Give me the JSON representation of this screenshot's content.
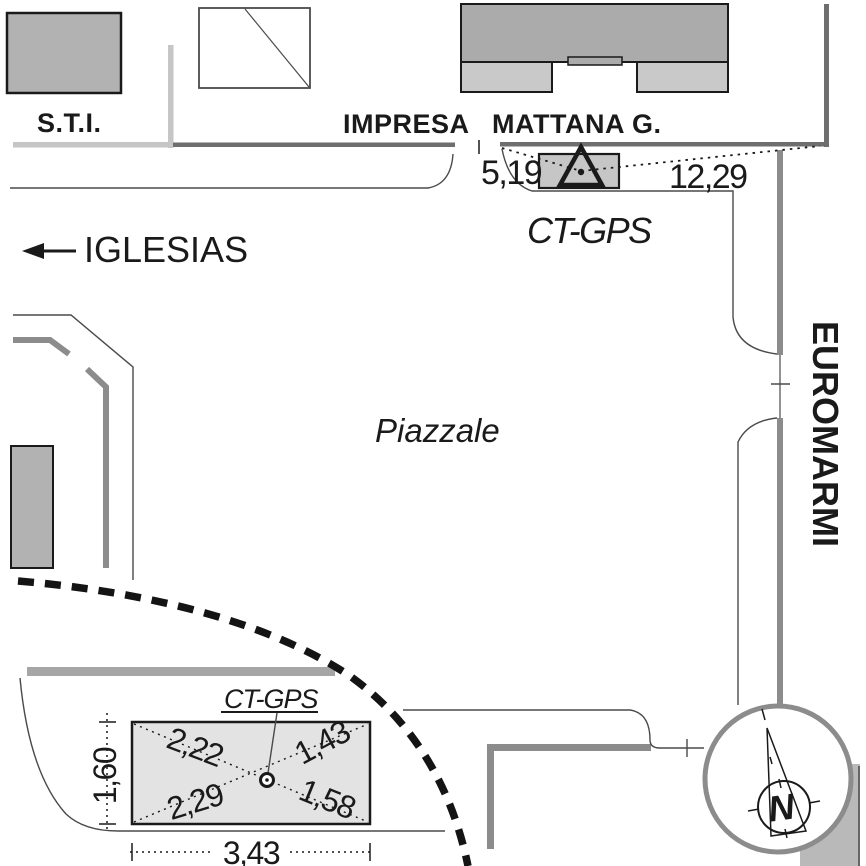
{
  "map": {
    "buildings": {
      "sti_label": "S.T.I.",
      "impresa_label": "IMPRESA",
      "mattana_label": "MATTANA G."
    },
    "station": {
      "name_label": "CT-GPS",
      "distance_left": "5,19",
      "distance_right": "12,29"
    },
    "labels": {
      "direction_city": "IGLESIAS",
      "square": "Piazzale",
      "road_company": "EUROMARMI"
    },
    "inset": {
      "point_label": "CT-GPS",
      "diag_upper_left": "2,22",
      "diag_upper_right": "1,43",
      "diag_lower_left": "2,29",
      "diag_lower_right": "1,58",
      "height_dim": "1,60",
      "width_dim": "3,43"
    },
    "compass": {
      "north_label": "N"
    }
  },
  "colors": {
    "ink": "#1a1a1a",
    "thin_line": "#4a4a4a",
    "white": "#ffffff",
    "road_light": "#c6c6c6",
    "road_dark": "#6e6e6e",
    "road_mid": "#8c8c8c",
    "building_dark": "#ababab",
    "building_mid": "#b2b2b2",
    "building_light": "#c9c9c9",
    "station_fill": "#c6c6c6",
    "inset_fill": "#e3e3e3",
    "bar_gray": "#a6a6a6",
    "crescent_gray": "#b9b9b9",
    "dashed_line": "#141414"
  }
}
